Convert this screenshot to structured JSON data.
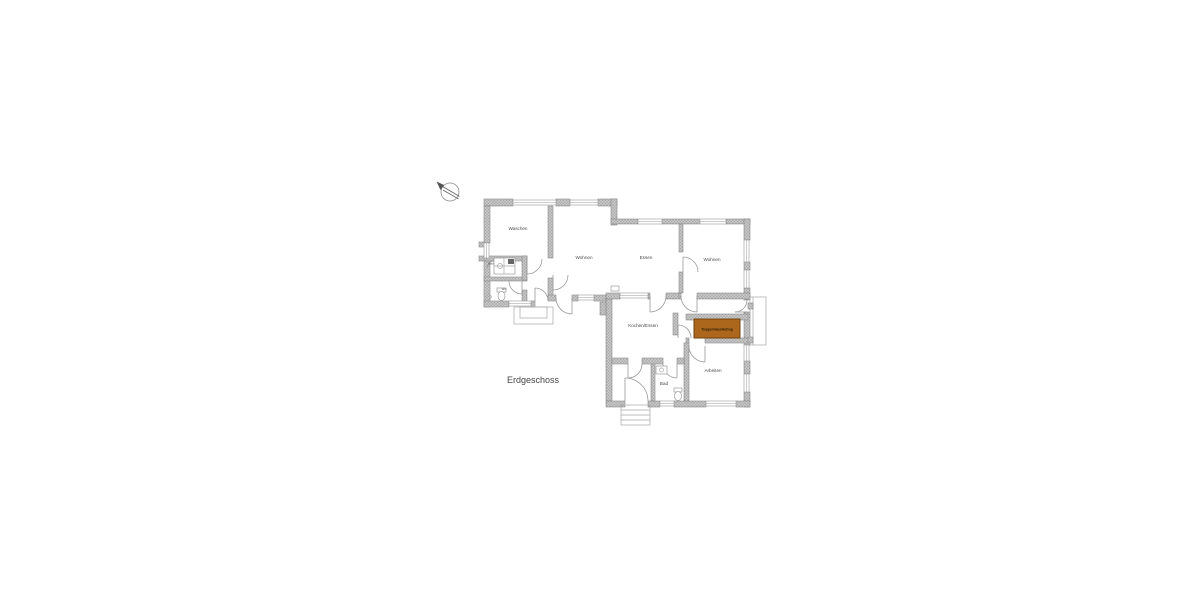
{
  "floor_label": "Erdgeschoss",
  "rooms": {
    "waschen": "Waschen",
    "wohnen_left": "Wohnen",
    "essen": "Essen",
    "wohnen_right": "Wohnen",
    "kochen_essen": "Kochen/Essen",
    "bad_upper": "Bad",
    "wc": "WC",
    "bad_lower": "Bad",
    "arbeiten": "Arbeiten"
  },
  "highlight": {
    "label": "Treppenhaus/Aufzug",
    "fill": "#ad671c",
    "border": "#6e4410",
    "text_color": "#2b1a04"
  },
  "colors": {
    "background": "#ffffff",
    "wall_fill": "#c6c6c6",
    "wall_speckle": "#7e7e7e",
    "wall_stroke": "#8a8a8a",
    "line": "#9a9a9a",
    "label_text": "#4a4a4a"
  },
  "icons": {
    "north_arrow": "north-arrow"
  }
}
